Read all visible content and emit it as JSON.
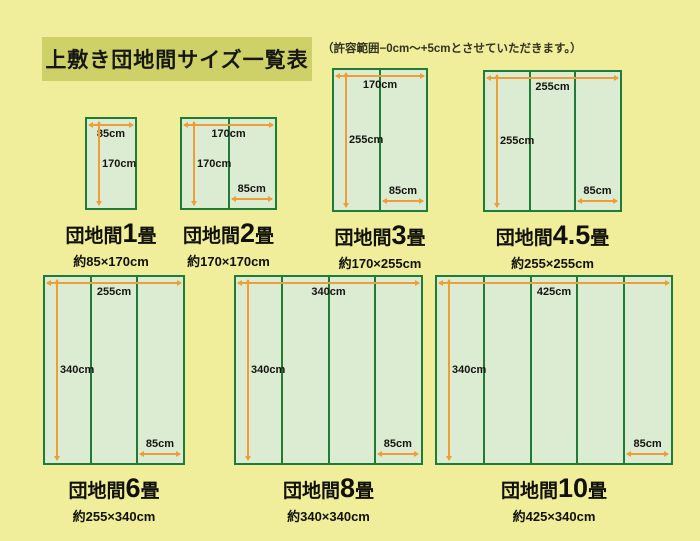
{
  "header": {
    "title": "上敷き団地間サイズ一覧表",
    "note": "（許容範囲−0cm～+5cmとさせていただきます。）"
  },
  "colors": {
    "background": "#f0ee9b",
    "title_box": "#ced167",
    "rug_border_green": "#1f7c38",
    "rug_fill_green": "#dcecd3",
    "arrow_orange": "#ed9f35",
    "text": "#111108"
  },
  "diagrams": [
    {
      "id": "danchima-1jo",
      "prefix": "団地間",
      "size": "1",
      "unit": "畳",
      "subtitle": "約85×170cm",
      "width_cm": 85,
      "height_cm": 170,
      "panels": 1,
      "top_label": "85cm",
      "side_label": "170cm",
      "panel_label": ""
    },
    {
      "id": "danchima-2jo",
      "prefix": "団地間",
      "size": "2",
      "unit": "畳",
      "subtitle": "約170×170cm",
      "width_cm": 170,
      "height_cm": 170,
      "panels": 2,
      "top_label": "170cm",
      "side_label": "170cm",
      "panel_label": "85cm"
    },
    {
      "id": "danchima-3jo",
      "prefix": "団地間",
      "size": "3",
      "unit": "畳",
      "subtitle": "約170×255cm",
      "width_cm": 170,
      "height_cm": 255,
      "panels": 2,
      "top_label": "170cm",
      "side_label": "255cm",
      "panel_label": "85cm"
    },
    {
      "id": "danchima-4-5jo",
      "prefix": "団地間",
      "size": "4.5",
      "unit": "畳",
      "subtitle": "約255×255cm",
      "width_cm": 255,
      "height_cm": 255,
      "panels": 3,
      "top_label": "255cm",
      "side_label": "255cm",
      "panel_label": "85cm"
    },
    {
      "id": "danchima-6jo",
      "prefix": "団地間",
      "size": "6",
      "unit": "畳",
      "subtitle": "約255×340cm",
      "width_cm": 255,
      "height_cm": 340,
      "panels": 3,
      "top_label": "255cm",
      "side_label": "340cm",
      "panel_label": "85cm"
    },
    {
      "id": "danchima-8jo",
      "prefix": "団地間",
      "size": "8",
      "unit": "畳",
      "subtitle": "約340×340cm",
      "width_cm": 340,
      "height_cm": 340,
      "panels": 4,
      "top_label": "340cm",
      "side_label": "340cm",
      "panel_label": "85cm"
    },
    {
      "id": "danchima-10jo",
      "prefix": "団地間",
      "size": "10",
      "unit": "畳",
      "subtitle": "約425×340cm",
      "width_cm": 425,
      "height_cm": 340,
      "panels": 5,
      "top_label": "425cm",
      "side_label": "340cm",
      "panel_label": "85cm"
    }
  ]
}
